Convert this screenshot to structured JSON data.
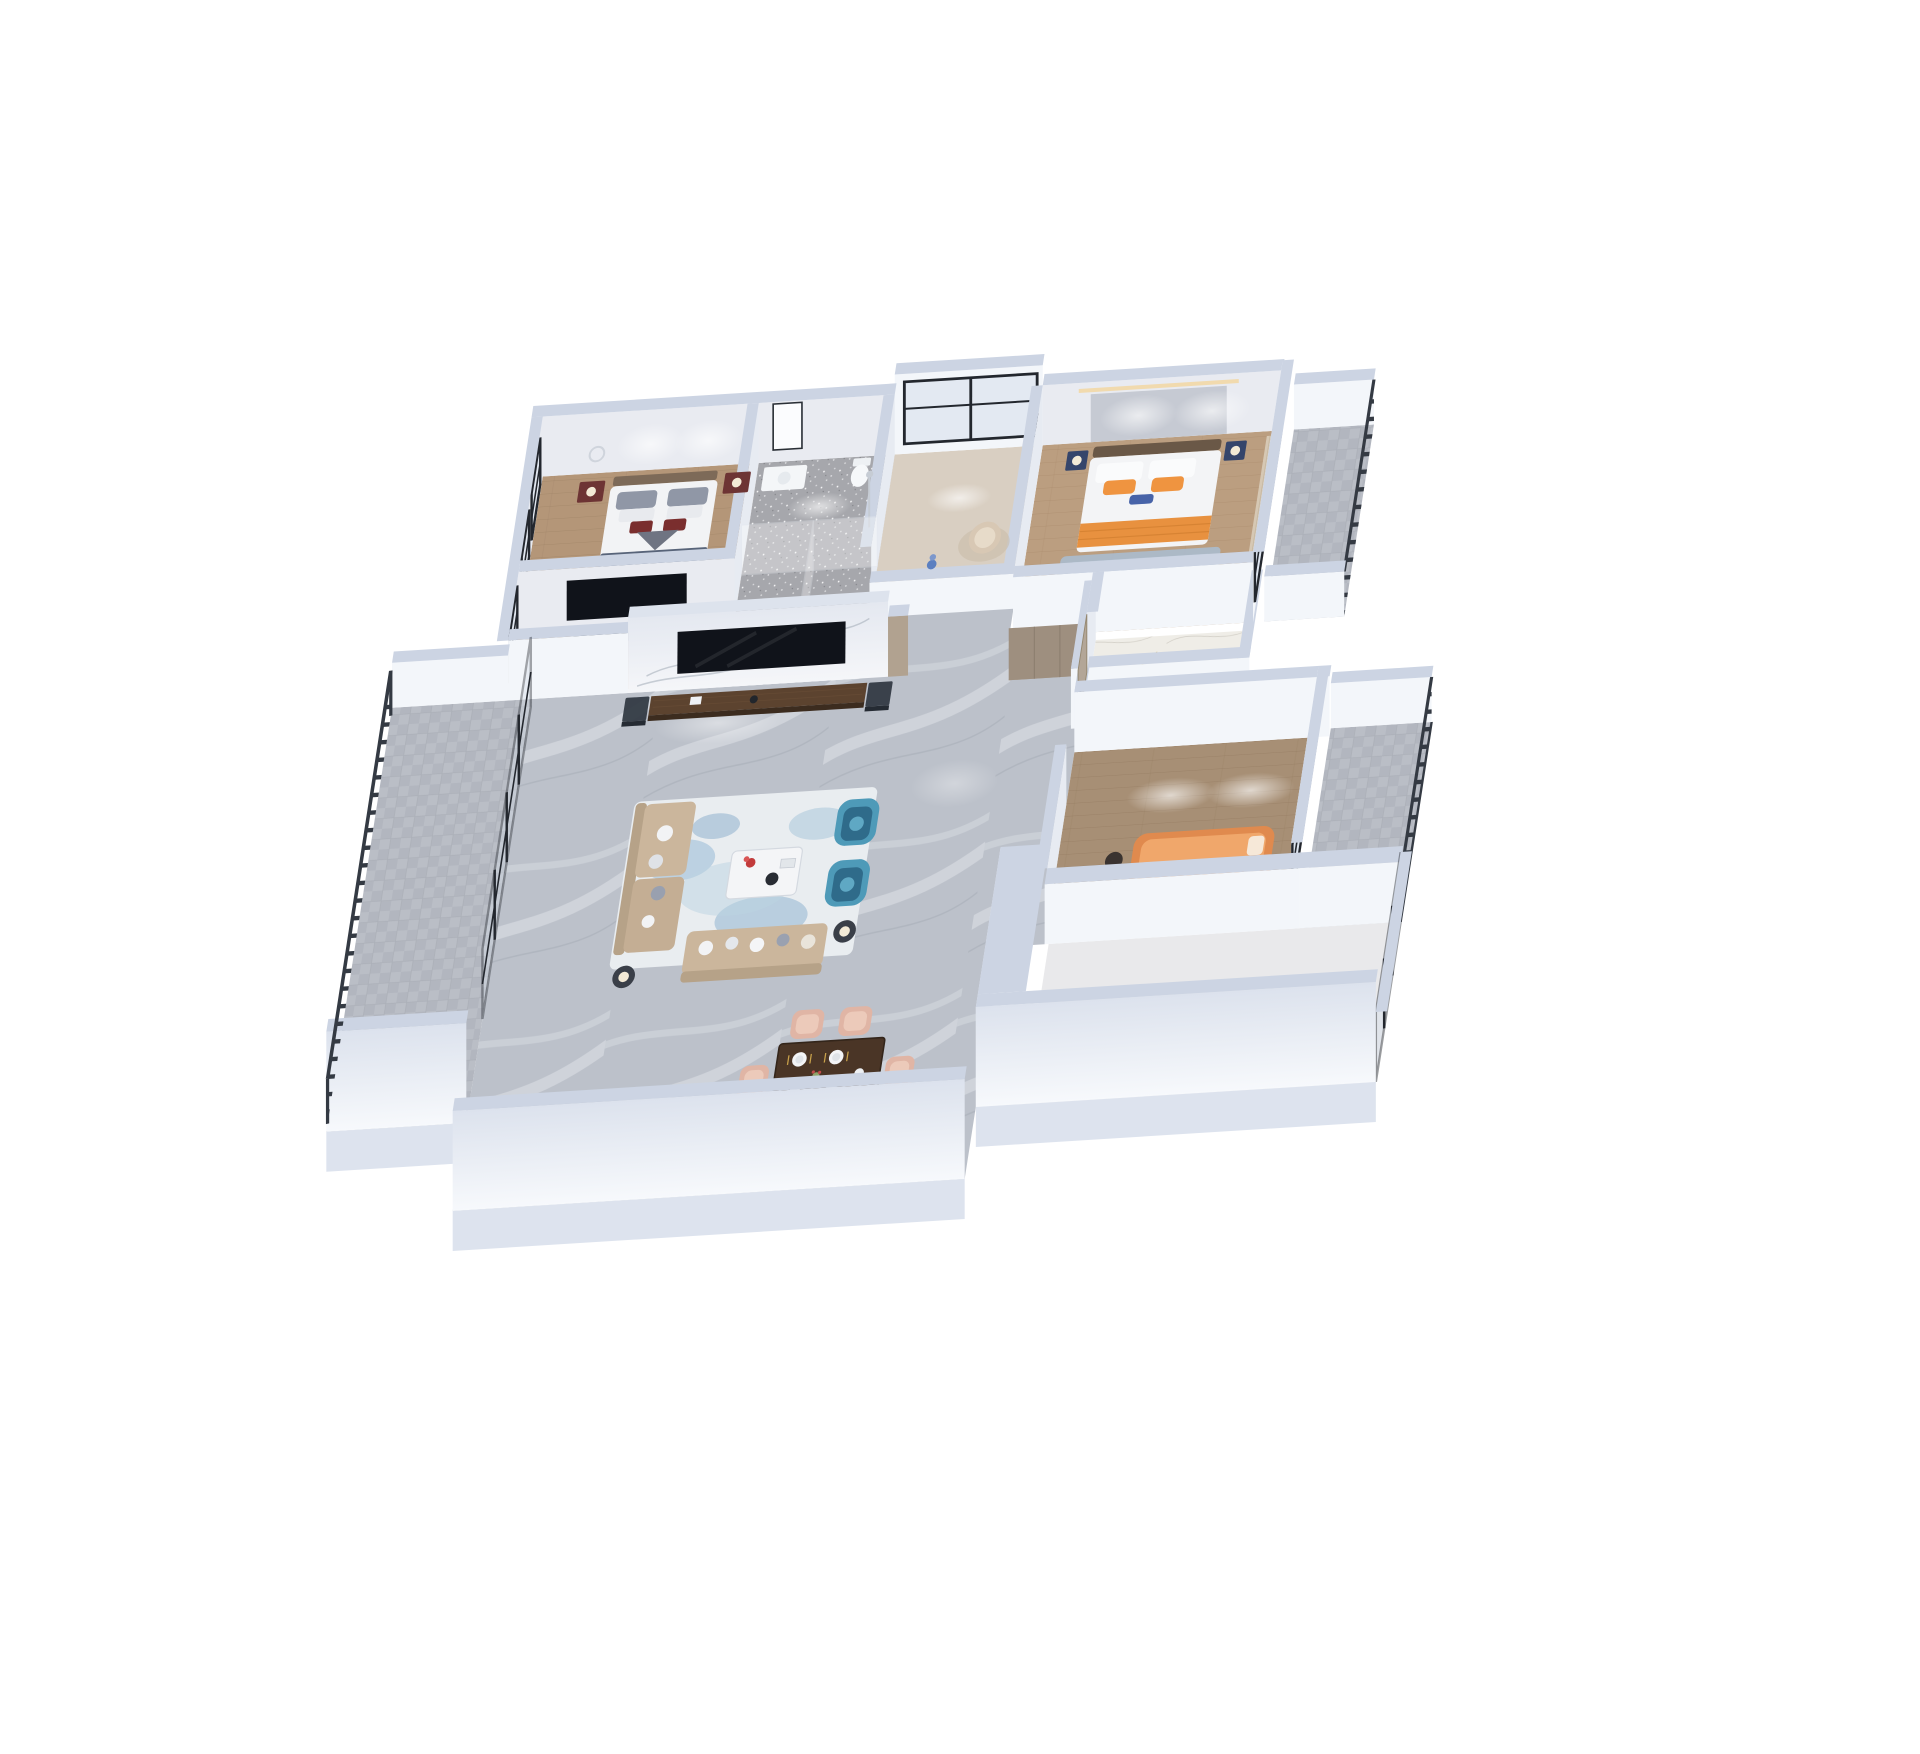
{
  "scene": {
    "type": "3d-isometric-floor-plan-render",
    "description": "Overhead axonometric dollhouse rendering of a three-bedroom apartment with cut-down walls, photoreal furniture, on a plain white background",
    "camera": "top-down axonometric, walls cut low, slight leftward shear",
    "background": "#ffffff",
    "rooms": [
      {
        "id": "bedroom-guest",
        "name": "Guest Bedroom",
        "floor": "light oak wood",
        "furniture": [
          "double bed with white bedding, grey and maroon accent pillows",
          "two dark red-brown nightstands with lamps",
          "metal ring wall sculpture",
          "wall spotlights",
          "TV on half partition wall"
        ]
      },
      {
        "id": "tv-nook",
        "name": "TV Nook",
        "floor": "light oak wood",
        "furniture": [
          "wall-mounted TV",
          "low media shelf"
        ]
      },
      {
        "id": "bathroom",
        "name": "Bathroom",
        "floor": "grey terrazzo tile",
        "furniture": [
          "white vanity with mirror",
          "toilet",
          "walk-in shower with chrome riser",
          "glass partition"
        ]
      },
      {
        "id": "study",
        "name": "Study",
        "floor": "pale wood",
        "furniture": [
          "full-height black framed window wall",
          "beige armchair",
          "blue figurine on half wall"
        ]
      },
      {
        "id": "master-bedroom",
        "name": "Master Bedroom",
        "floor": "oak wood",
        "furniture": [
          "king bed with white duvet, orange pillows and orange throw",
          "two navy nightstands with lamps",
          "blue runner rug",
          "warm cove lighting",
          "floor-to-ceiling windows with beige curtain"
        ]
      },
      {
        "id": "walk-in-closet",
        "name": "Walk-in Closet",
        "floor": "white marble with gold veining",
        "furniture": []
      },
      {
        "id": "hallway",
        "name": "Entry Hall & Corridor",
        "floor": "grey marble",
        "furniture": [
          "taupe wardrobe cabinets",
          "taupe entry door with handle"
        ]
      },
      {
        "id": "living-room",
        "name": "Living Room",
        "floor": "grey marble",
        "furniture": [
          "white marble TV feature wall",
          "dark walnut media console",
          "two smoked-glass display cabinets",
          "beige L-shaped sofa",
          "beige three-seat sofa",
          "two teal wing chairs",
          "white coffee table with red flowers",
          "abstract blue-white rug",
          "two dark side tables with lamps"
        ]
      },
      {
        "id": "dining-area",
        "name": "Dining Area",
        "floor": "grey marble",
        "furniture": [
          "dark walnut dining table set for four",
          "four blush-pink chairs",
          "small plant centerpiece",
          "gold cutlery"
        ]
      },
      {
        "id": "bedroom-second",
        "name": "Second Bedroom",
        "floor": "grey-brown wood",
        "furniture": [
          "low orange upholstered bed",
          "dark side table",
          "ceiling spotlights",
          "black framed window wall"
        ]
      },
      {
        "id": "south-room",
        "name": "South Room / Kitchen",
        "floor": "pale stone",
        "furniture": [
          "ceiling light pools",
          "glass door wall to balcony"
        ]
      },
      {
        "id": "balcony-west",
        "name": "West Balcony",
        "floor": "grey carpet tile",
        "furniture": [
          "dark metal bar railing",
          "black framed glass sliding doors"
        ]
      },
      {
        "id": "balcony-east",
        "name": "East Balcony",
        "floor": "grey carpet tile",
        "furniture": [
          "dark metal bar railing"
        ]
      },
      {
        "id": "balcony-north-east",
        "name": "North-East Balcony",
        "floor": "grey carpet tile",
        "furniture": [
          "dark metal bar railing"
        ]
      }
    ],
    "palette": {
      "bg": "#ffffff",
      "wall_cap": "#ccd4e3",
      "wall_face": "#f3f6fa",
      "wall_face_sh": "#e7ebf2",
      "wall_face_int": "#e9ebf1",
      "front_wall_top": "#f7f9fc",
      "front_wall_bottom": "#dce2ed",
      "skirt": "#dde3ee",
      "frame_dark": "#23272e",
      "glass": "#d7dfe9",
      "rail_dark": "#343a43",
      "terrazzo": "#a6a7ac",
      "carpet": "#b7bbc3",
      "marble_grey": "#bcc1ca",
      "marble_gold": "#efede7",
      "gold_vein": "#cdb26a",
      "kitchen_floor": "#e9e9eb",
      "wood_guest": "#b49678",
      "wood_master": "#bb9e80",
      "wood_second": "#a78f75",
      "sofa_beige": "#cbb69c",
      "sofa_beige_dark": "#b6a288",
      "chair_teal": "#4e9ab8",
      "chair_teal_dark": "#2f6b8a",
      "rug_base": "#e9edf0",
      "rug_blue": "#7fa9c9",
      "table_walnut": "#4a3526",
      "chair_blush": "#e0b5a5",
      "chair_blush_light": "#eccaba",
      "bed_white": "#f3f4f6",
      "pillow_grey": "#9097a6",
      "pillow_maroon": "#7a2e2e",
      "accent_orange": "#ef9440",
      "orange_throw": "#e8913f",
      "bed_second_orange": "#e08a4e",
      "nightstand_red": "#6d3434",
      "nightstand_navy": "#35456b",
      "taupe_wood": "#b1a290",
      "door_taupe": "#b3a697",
      "console_walnut": "#5c432f",
      "tv_black": "#10131a",
      "lamp_warm": "#f3ead6"
    }
  }
}
